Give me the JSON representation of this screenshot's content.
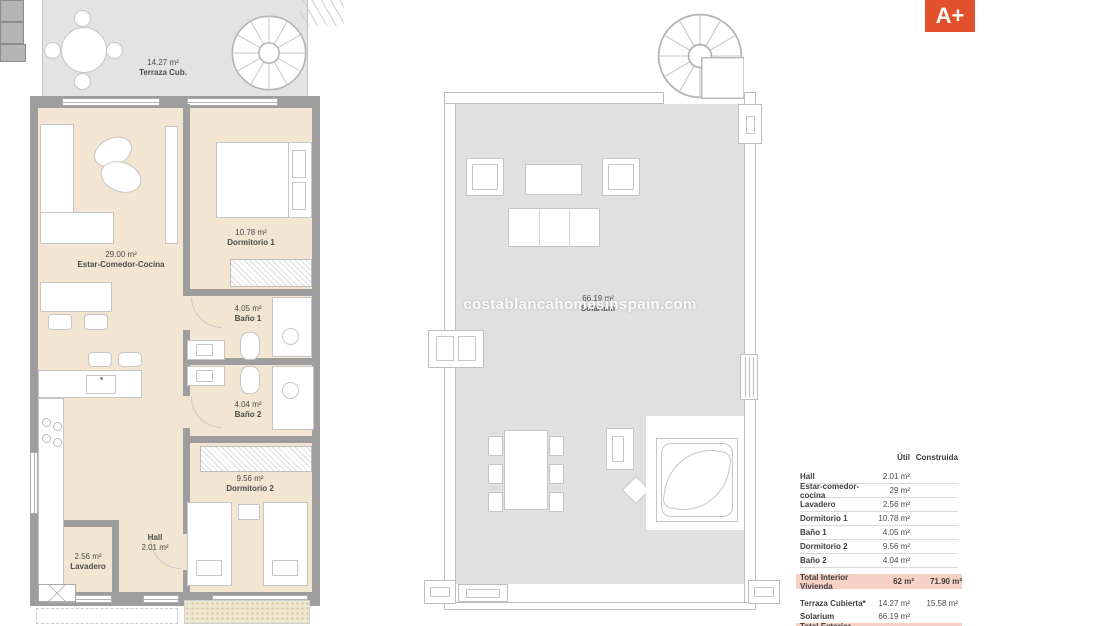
{
  "energy_badge": {
    "label": "A+",
    "bg_color": "#e2512b"
  },
  "watermark": "costablancahomesinspain.com",
  "rooms": {
    "terraza": {
      "line1": "14.27 m²",
      "line2": "Terraza Cub."
    },
    "estar": {
      "line1": "29.00 m²",
      "line2": "Estar-Comedor-Cocina"
    },
    "dormitorio1": {
      "line1": "10.78 m²",
      "line2": "Dormitorio 1"
    },
    "bano1": {
      "line1": "4.05 m²",
      "line2": "Baño 1"
    },
    "bano2": {
      "line1": "4.04 m²",
      "line2": "Baño 2"
    },
    "dormitorio2": {
      "line1": "9.56 m²",
      "line2": "Dormitorio 2"
    },
    "hall": {
      "line1": "Hall",
      "line2": "2.01 m²"
    },
    "lavadero": {
      "line1": "2.56 m²",
      "line2": "Lavadero"
    },
    "solarium": {
      "line1": "66.19 m²",
      "line2": "Solarium"
    }
  },
  "area_table": {
    "header": {
      "util": "Útil",
      "built": "Construida"
    },
    "rows": [
      {
        "label": "Hall",
        "util": "2.01 m²",
        "built": ""
      },
      {
        "label": "Estar-comedor-cocina",
        "util": "29 m²",
        "built": ""
      },
      {
        "label": "Lavadero",
        "util": "2.56 m²",
        "built": ""
      },
      {
        "label": "Dormitorio 1",
        "util": "10.78 m²",
        "built": ""
      },
      {
        "label": "Baño 1",
        "util": "4.05 m²",
        "built": ""
      },
      {
        "label": "Dormitorio 2",
        "util": "9.56 m²",
        "built": ""
      },
      {
        "label": "Baño 2",
        "util": "4.04 m²",
        "built": ""
      }
    ],
    "total_interior": {
      "label": "Total Interior Vivienda",
      "util": "62 m²",
      "built": "71.90 m²"
    },
    "exterior_rows": [
      {
        "label": "Terraza Cubierta*",
        "util": "14.27 m²",
        "built": "15.58 m²"
      },
      {
        "label": "Solarium",
        "util": "66.19 m²",
        "built": ""
      }
    ],
    "total_exterior": {
      "label": "Total Exterior Vivienda",
      "util": "80.46 m²",
      "built": "15.58 m²"
    }
  },
  "colors": {
    "floor_beige": "#f2e5d1",
    "terrace_gray": "#e0e0e0",
    "wall_gray": "#9d9d9d",
    "highlight_pink": "#f7d0c6",
    "badge_orange": "#e2512b"
  }
}
